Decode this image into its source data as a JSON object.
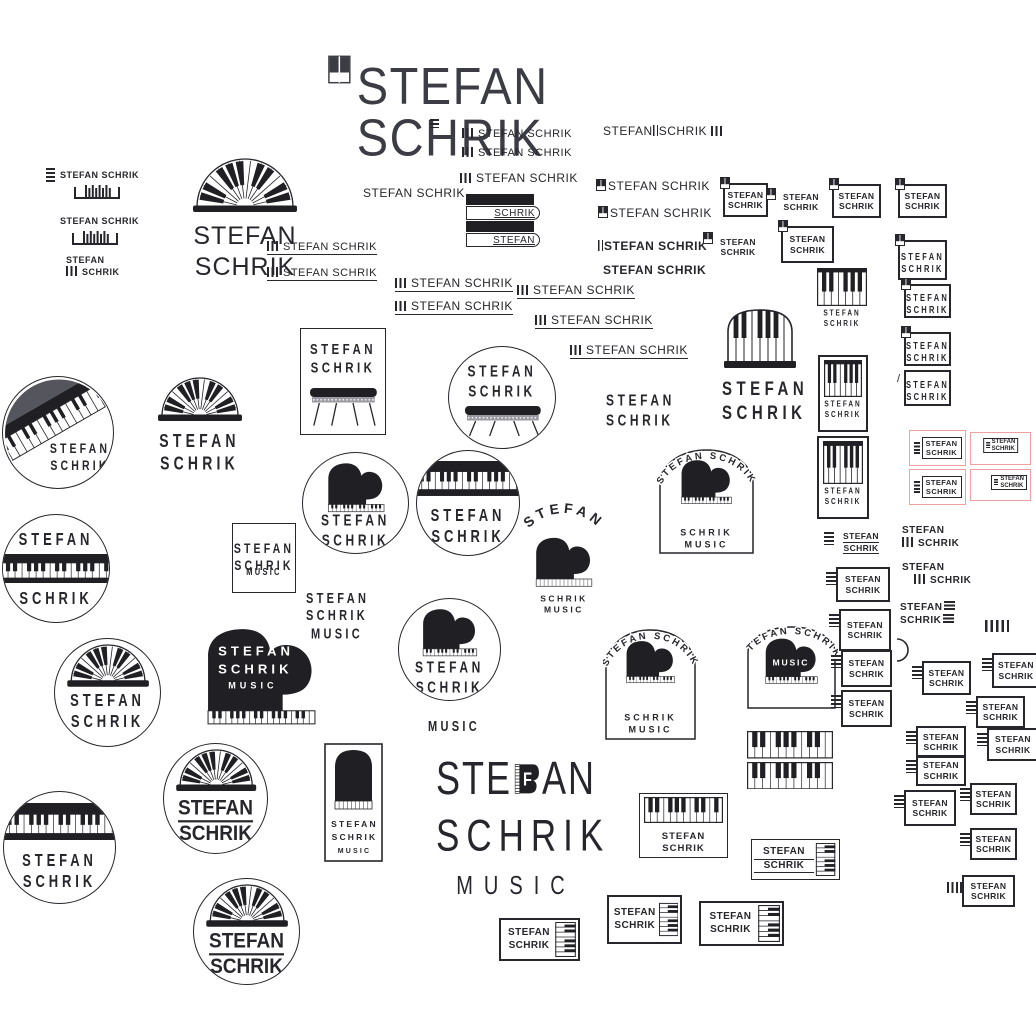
{
  "brand": "STEFAN SCHRIK",
  "tagline_word": "MUSIC",
  "colors": {
    "ink": "#26262c",
    "piano_black": "#1f1f24",
    "card_pink": "#efa0a0",
    "diag_gray": "#55555e"
  },
  "items": [
    {
      "k": "title",
      "x": 328,
      "y": 52,
      "w": 386,
      "h": 62,
      "text": "STEFAN SCHRIK"
    },
    {
      "k": "kg",
      "v": "h",
      "x": 430,
      "y": 119,
      "w": 9,
      "h": 9
    },
    {
      "k": "kg",
      "v": "h",
      "x": 46,
      "y": 168,
      "w": 9,
      "h": 15
    },
    {
      "k": "t",
      "x": 60,
      "y": 170,
      "fs": 9,
      "fw": 700,
      "lines": [
        "STEFAN SCHRIK"
      ]
    },
    {
      "k": "kg",
      "v": "bracket",
      "x": 74,
      "y": 184,
      "w": 46,
      "h": 15
    },
    {
      "k": "t",
      "x": 60,
      "y": 216,
      "fs": 9,
      "fw": 700,
      "lines": [
        "STEFAN SCHRIK"
      ]
    },
    {
      "k": "kg",
      "v": "bracket",
      "x": 72,
      "y": 230,
      "w": 46,
      "h": 15
    },
    {
      "k": "t",
      "x": 66,
      "y": 255,
      "fs": 9,
      "fw": 700,
      "lines": [
        "STEFAN",
        "[v]SCHRIK"
      ]
    },
    {
      "k": "fan",
      "x": 170,
      "y": 158,
      "w": 150,
      "h": 100,
      "fw2": 148,
      "fh": 54,
      "fs": 25,
      "plain": 1,
      "lines": [
        "STEFAN",
        "SCHRIK"
      ]
    },
    {
      "k": "tu",
      "x": 267,
      "y": 237,
      "fs": 11,
      "text": "[v]STEFAN SCHRIK"
    },
    {
      "k": "tu",
      "x": 267,
      "y": 263,
      "fs": 11,
      "text": "[v]STEFAN SCHRIK"
    },
    {
      "k": "t",
      "x": 462,
      "y": 128,
      "fs": 11,
      "lines": [
        "[v]STEFAN SCHRIK"
      ]
    },
    {
      "k": "t",
      "x": 462,
      "y": 147,
      "fs": 11,
      "lines": [
        "[v]STEFAN SCHRIK"
      ]
    },
    {
      "k": "t",
      "x": 460,
      "y": 171,
      "fs": 12,
      "lines": [
        "[v]STEFAN SCHRIK"
      ]
    },
    {
      "k": "keystack",
      "x": 466,
      "y": 194,
      "w": 74,
      "h": 52,
      "top": "SCHRIK",
      "bottom": "STEFAN"
    },
    {
      "k": "t",
      "x": 603,
      "y": 124,
      "fs": 12,
      "lines": [
        "STEFAN[l]SCHRIK [v]"
      ]
    },
    {
      "k": "t",
      "x": 596,
      "y": 179,
      "fs": 12,
      "lines": [
        "[q]STEFAN SCHRIK"
      ]
    },
    {
      "k": "t",
      "x": 598,
      "y": 206,
      "fs": 12,
      "lines": [
        "[q]STEFAN SCHRIK"
      ]
    },
    {
      "k": "t",
      "x": 598,
      "y": 239,
      "fs": 12,
      "fw": 600,
      "lines": [
        "[l]STEFAN SCHRIK"
      ]
    },
    {
      "k": "t",
      "x": 603,
      "y": 263,
      "fs": 12,
      "fw": 700,
      "lines": [
        "STEFAN SCHRIK"
      ]
    },
    {
      "k": "t",
      "x": 363,
      "y": 186,
      "fs": 12,
      "lines": [
        "STEFAN SCHRIK"
      ]
    },
    {
      "k": "tu",
      "x": 395,
      "y": 274,
      "fs": 12,
      "text": "[v]STEFAN SCHRIK"
    },
    {
      "k": "tu",
      "x": 395,
      "y": 297,
      "fs": 12,
      "text": "[v]STEFAN SCHRIK"
    },
    {
      "k": "tu",
      "x": 517,
      "y": 281,
      "fs": 12,
      "text": "[v]STEFAN SCHRIK"
    },
    {
      "k": "tu",
      "x": 535,
      "y": 311,
      "fs": 12,
      "text": "[v]STEFAN SCHRIK"
    },
    {
      "k": "tu",
      "x": 570,
      "y": 341,
      "fs": 12,
      "text": "[v]STEFAN SCHRIK"
    },
    {
      "k": "badge",
      "x": 723,
      "y": 183,
      "w": 41,
      "h": 30,
      "pre": "q",
      "lines": [
        "STEFAN",
        "SCHRIK"
      ]
    },
    {
      "k": "badge",
      "x": 779,
      "y": 188,
      "w": 44,
      "h": 28,
      "nb": 1,
      "pre": "q",
      "lines": [
        "STEFAN",
        "SCHRIK"
      ]
    },
    {
      "k": "badge",
      "x": 832,
      "y": 184,
      "w": 45,
      "h": 30,
      "pre": "q",
      "lines": [
        "STEFAN",
        "SCHRIK"
      ]
    },
    {
      "k": "badge",
      "x": 898,
      "y": 184,
      "w": 45,
      "h": 30,
      "pre": "q",
      "lines": [
        "STEFAN",
        "SCHRIK"
      ]
    },
    {
      "k": "badge",
      "x": 716,
      "y": 232,
      "w": 44,
      "h": 30,
      "nb": 1,
      "pre": "q",
      "lines": [
        "STEFAN",
        "SCHRIK"
      ]
    },
    {
      "k": "badge",
      "x": 781,
      "y": 226,
      "w": 49,
      "h": 33,
      "pre": "q",
      "lines": [
        "STEFAN",
        "SCHRIK"
      ]
    },
    {
      "k": "badge",
      "x": 898,
      "y": 240,
      "w": 45,
      "h": 36,
      "pre": "q",
      "sp": 1,
      "lines": [
        "STEFAN",
        "SCHRIK"
      ]
    },
    {
      "k": "keysv",
      "x": 816,
      "y": 265,
      "w": 52,
      "h": 70,
      "nb": 1,
      "lines": [
        "STEFAN",
        "SCHRIK"
      ]
    },
    {
      "k": "badge",
      "x": 904,
      "y": 284,
      "w": 43,
      "h": 30,
      "pre": "q",
      "sp": 1,
      "lines": [
        "STEFAN",
        "SCHRIK"
      ]
    },
    {
      "k": "badge",
      "x": 904,
      "y": 332,
      "w": 43,
      "h": 30,
      "pre": "q",
      "sp": 1,
      "lines": [
        "STEFAN",
        "SCHRIK"
      ]
    },
    {
      "k": "keysv",
      "x": 818,
      "y": 355,
      "w": 50,
      "h": 77,
      "lines": [
        "STEFAN",
        "SCHRIK"
      ]
    },
    {
      "k": "badge",
      "x": 904,
      "y": 370,
      "w": 43,
      "h": 32,
      "pre": "s",
      "sp": 1,
      "lines": [
        "STEFAN",
        "SCHRIK"
      ]
    },
    {
      "k": "keysv",
      "x": 817,
      "y": 436,
      "w": 52,
      "h": 83,
      "lines": [
        "STEFAN",
        "SCHRIK"
      ]
    },
    {
      "k": "redcard",
      "x": 909,
      "y": 430,
      "w": 57,
      "h": 36,
      "v": "front",
      "lines": [
        "STEFAN",
        "SCHRIK"
      ]
    },
    {
      "k": "redcard",
      "x": 970,
      "y": 432,
      "w": 61,
      "h": 33,
      "v": "backc",
      "lines": [
        "STEFAN",
        "SCHRIK"
      ]
    },
    {
      "k": "redcard",
      "x": 909,
      "y": 469,
      "w": 57,
      "h": 36,
      "v": "front",
      "lines": [
        "STEFAN",
        "SCHRIK"
      ]
    },
    {
      "k": "redcard",
      "x": 970,
      "y": 469,
      "w": 61,
      "h": 32,
      "v": "backr",
      "lines": [
        "STEFAN",
        "SCHRIK"
      ]
    },
    {
      "k": "circle",
      "v": "diag",
      "x": 2,
      "y": 376,
      "w": 112,
      "h": 113,
      "lines": [
        "STEFAN",
        "SCHRIK"
      ]
    },
    {
      "k": "circle",
      "v": "band",
      "x": 2,
      "y": 514,
      "w": 108,
      "h": 109,
      "lines": [
        "STEFAN",
        "SCHRIK"
      ]
    },
    {
      "k": "fan",
      "x": 142,
      "y": 377,
      "w": 115,
      "h": 95,
      "fw2": 112,
      "fh": 44,
      "fs": 14,
      "sp": 1,
      "lines": [
        "STEFAN",
        "SCHRIK"
      ]
    },
    {
      "k": "card",
      "v": "side",
      "x": 300,
      "y": 328,
      "w": 86,
      "h": 107,
      "lines": [
        "STEFAN",
        "SCHRIK"
      ]
    },
    {
      "k": "circle",
      "v": "side",
      "x": 448,
      "y": 346,
      "w": 108,
      "h": 103,
      "lines": [
        "STEFAN",
        "SCHRIK"
      ]
    },
    {
      "k": "circle",
      "v": "grand",
      "x": 302,
      "y": 452,
      "w": 107,
      "h": 102,
      "lines": [
        "STEFAN",
        "SCHRIK"
      ]
    },
    {
      "k": "circle",
      "v": "bandtop",
      "x": 416,
      "y": 450,
      "w": 104,
      "h": 106,
      "lines": [
        "STEFAN",
        "SCHRIK"
      ]
    },
    {
      "k": "arcfree",
      "x": 518,
      "y": 497,
      "w": 92,
      "h": 120,
      "arc": "STEFAN",
      "lines": [
        "SCHRIK",
        "MUSIC"
      ]
    },
    {
      "k": "t",
      "x": 606,
      "y": 391,
      "fs": 12,
      "sp": 1,
      "ctr": 1,
      "w": 56,
      "lines": [
        "STEFAN",
        "SCHRIK"
      ]
    },
    {
      "k": "sq",
      "x": 232,
      "y": 523,
      "w": 64,
      "h": 70,
      "lines": [
        "STEFAN",
        "SCHRIK",
        "MUSIC"
      ]
    },
    {
      "k": "t",
      "x": 306,
      "y": 591,
      "fs": 11,
      "sp": 1,
      "ctr": 1,
      "w": 62,
      "lines": [
        "STEFAN",
        "SCHRIK",
        "MUSIC"
      ]
    },
    {
      "k": "arcbadge",
      "x": 657,
      "y": 442,
      "w": 99,
      "h": 114,
      "arc": "STEFAN SCHRIK",
      "lines": [
        "SCHRIK",
        "MUSIC"
      ]
    },
    {
      "k": "archpiano",
      "x": 722,
      "y": 304,
      "w": 76,
      "h": 116,
      "lines": [
        "STEFAN",
        "SCHRIK"
      ]
    },
    {
      "k": "grandblack",
      "x": 202,
      "y": 626,
      "w": 119,
      "h": 106,
      "lines": [
        "STEFAN",
        "SCHRIK",
        "MUSIC"
      ]
    },
    {
      "k": "circle",
      "v": "arch",
      "x": 54,
      "y": 638,
      "w": 107,
      "h": 109,
      "sp": 1,
      "lines": [
        "STEFAN",
        "SCHRIK"
      ]
    },
    {
      "k": "circle",
      "v": "grand",
      "x": 398,
      "y": 598,
      "w": 103,
      "h": 103,
      "lines": [
        "STEFAN",
        "SCHRIK"
      ]
    },
    {
      "k": "t",
      "x": 428,
      "y": 719,
      "fs": 11,
      "sp": 1,
      "lines": [
        "MUSIC"
      ]
    },
    {
      "k": "arcbadge",
      "x": 603,
      "y": 622,
      "w": 95,
      "h": 120,
      "arc": "STEFAN SCHRIK",
      "lines": [
        "SCHRIK",
        "MUSIC"
      ]
    },
    {
      "k": "arcbadge",
      "x": 745,
      "y": 619,
      "w": 93,
      "h": 92,
      "arc": "STEFAN SCHRIK",
      "music": "MUSIC",
      "lines": []
    },
    {
      "k": "keysgrid",
      "x": 747,
      "y": 731,
      "w": 86,
      "h": 59
    },
    {
      "k": "circle",
      "v": "arch",
      "x": 163,
      "y": 743,
      "w": 105,
      "h": 111,
      "rule": 1,
      "lines": [
        "STEFAN",
        "SCHRIK"
      ]
    },
    {
      "k": "card",
      "v": "round",
      "x": 324,
      "y": 743,
      "w": 59,
      "h": 119,
      "lines": [
        "STEFAN",
        "SCHRIK",
        "MUSIC"
      ]
    },
    {
      "k": "musicbig",
      "x": 436,
      "y": 752,
      "w": 160,
      "h": 154,
      "a": "STE",
      "f": "F",
      "b": "AN",
      "l2": "SCHRIK",
      "l3": "MUSIC"
    },
    {
      "k": "circle",
      "v": "bandtop",
      "x": 3,
      "y": 791,
      "w": 113,
      "h": 113,
      "lines": [
        "STEFAN",
        "SCHRIK"
      ]
    },
    {
      "k": "circle",
      "v": "arch",
      "x": 193,
      "y": 878,
      "w": 107,
      "h": 107,
      "rule": 1,
      "lines": [
        "STEFAN",
        "SCHRIK"
      ]
    },
    {
      "k": "keybadge",
      "x": 499,
      "y": 918,
      "w": 81,
      "h": 43,
      "lines": [
        "STEFAN",
        "SCHRIK"
      ]
    },
    {
      "k": "badge",
      "x": 836,
      "y": 529,
      "w": 50,
      "h": 27,
      "pre": "h",
      "nb": 1,
      "ul": 1,
      "lines": [
        "STEFAN",
        "SCHRIK"
      ]
    },
    {
      "k": "badge",
      "x": 836,
      "y": 567,
      "w": 50,
      "h": 31,
      "pre": "h",
      "lines": [
        "STEFAN",
        "SCHRIK"
      ]
    },
    {
      "k": "t",
      "x": 902,
      "y": 525,
      "fs": 10,
      "fw": 700,
      "lines": [
        "STEFAN",
        "[v]SCHRIK"
      ]
    },
    {
      "k": "t",
      "x": 902,
      "y": 562,
      "fs": 10,
      "fw": 700,
      "ind": 1,
      "lines": [
        "STEFAN",
        "[v]SCHRIK"
      ]
    },
    {
      "k": "t",
      "x": 900,
      "y": 601,
      "fs": 10,
      "fw": 700,
      "lines": [
        "STEFAN[h]",
        "SCHRIK[h]"
      ]
    },
    {
      "k": "kg",
      "v": "v",
      "x": 985,
      "y": 620,
      "w": 24,
      "h": 12
    },
    {
      "k": "badge",
      "x": 839,
      "y": 609,
      "w": 48,
      "h": 38,
      "pre": "h",
      "lines": [
        "STEFAN",
        "SCHRIK"
      ]
    },
    {
      "k": "badge",
      "x": 841,
      "y": 650,
      "w": 47,
      "h": 33,
      "pre": "h",
      "lines": [
        "STEFAN",
        "SCHRIK"
      ]
    },
    {
      "k": "badge",
      "x": 841,
      "y": 690,
      "w": 47,
      "h": 33,
      "pre": "h",
      "lines": [
        "STEFAN",
        "SCHRIK"
      ]
    },
    {
      "k": "kg",
      "v": "arc",
      "x": 895,
      "y": 637,
      "w": 15,
      "h": 26
    },
    {
      "k": "badge",
      "x": 922,
      "y": 661,
      "w": 45,
      "h": 30,
      "pre": "h",
      "lines": [
        "STEFAN",
        "SCHRIK"
      ]
    },
    {
      "k": "badge",
      "x": 992,
      "y": 653,
      "w": 44,
      "h": 31,
      "pre": "h",
      "lines": [
        "STEFAN",
        "SCHRIK"
      ]
    },
    {
      "k": "badge",
      "x": 976,
      "y": 696,
      "w": 45,
      "h": 28,
      "pre": "h",
      "lines": [
        "STEFAN",
        "SCHRIK"
      ]
    },
    {
      "k": "badge",
      "x": 916,
      "y": 726,
      "w": 46,
      "h": 28,
      "pre": "h",
      "lines": [
        "STEFAN",
        "SCHRIK"
      ]
    },
    {
      "k": "badge",
      "x": 987,
      "y": 728,
      "w": 48,
      "h": 29,
      "pre": "h",
      "lines": [
        "STEFAN",
        "SCHRIK"
      ]
    },
    {
      "k": "badge",
      "x": 916,
      "y": 755,
      "w": 46,
      "h": 27,
      "pre": "h",
      "lines": [
        "STEFAN",
        "SCHRIK"
      ]
    },
    {
      "k": "badge",
      "x": 904,
      "y": 790,
      "w": 48,
      "h": 32,
      "pre": "h",
      "lines": [
        "STEFAN",
        "SCHRIK"
      ]
    },
    {
      "k": "badge",
      "x": 970,
      "y": 783,
      "w": 43,
      "h": 28,
      "pre": "h",
      "lines": [
        "STEFAN",
        "SCHRIK"
      ]
    },
    {
      "k": "badge",
      "x": 970,
      "y": 828,
      "w": 43,
      "h": 28,
      "pre": "h",
      "lines": [
        "STEFAN",
        "SCHRIK"
      ]
    },
    {
      "k": "badge",
      "x": 962,
      "y": 875,
      "w": 49,
      "h": 28,
      "pre": "v",
      "lines": [
        "STEFAN",
        "SCHRIK"
      ]
    },
    {
      "k": "keytop",
      "x": 639,
      "y": 793,
      "w": 89,
      "h": 65,
      "lines": [
        "STEFAN",
        "SCHRIK"
      ]
    },
    {
      "k": "keybadge",
      "x": 751,
      "y": 839,
      "w": 89,
      "h": 41,
      "ul": 1,
      "lines": [
        "STEFAN",
        "SCHRIK"
      ]
    },
    {
      "k": "keybadge",
      "x": 607,
      "y": 895,
      "w": 75,
      "h": 49,
      "lines": [
        "STEFAN",
        "SCHRIK"
      ]
    },
    {
      "k": "keybadge",
      "x": 699,
      "y": 901,
      "w": 85,
      "h": 45,
      "lines": [
        "STEFAN",
        "SCHRIK"
      ]
    }
  ]
}
